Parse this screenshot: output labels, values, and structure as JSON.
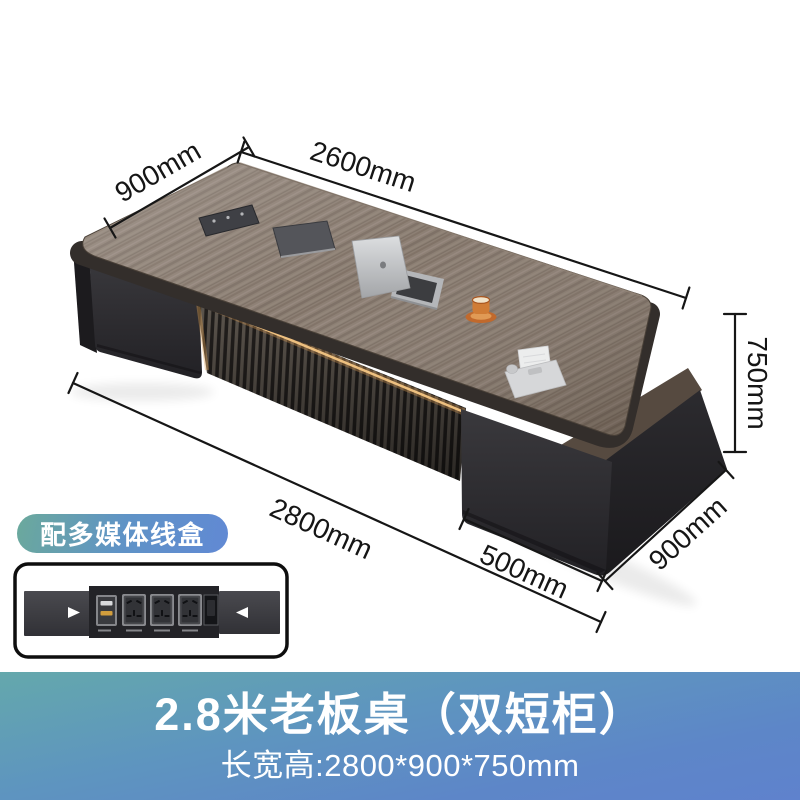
{
  "dimensions": {
    "top_length": "2600mm",
    "top_depth": "900mm",
    "height": "750mm",
    "bottom_length": "2800mm",
    "right_cabinet_width": "500mm",
    "right_depth": "900mm"
  },
  "badge": {
    "label": "配多媒体线盒"
  },
  "banner": {
    "title": "2.8米老板桌（双短柜）",
    "subtitle": "长宽高:2800*900*750mm",
    "gradient_top_color": "#64a8ac",
    "gradient_bottom_color": "#5f82cd"
  },
  "colors": {
    "dimension_line": "#161616",
    "desk_wood": "#86786c",
    "cabinet_dark": "#2c2b2e",
    "led_glow": "#e8b26a",
    "badge_gradient_left": "#6ba99c",
    "badge_gradient_right": "#6189d4"
  }
}
